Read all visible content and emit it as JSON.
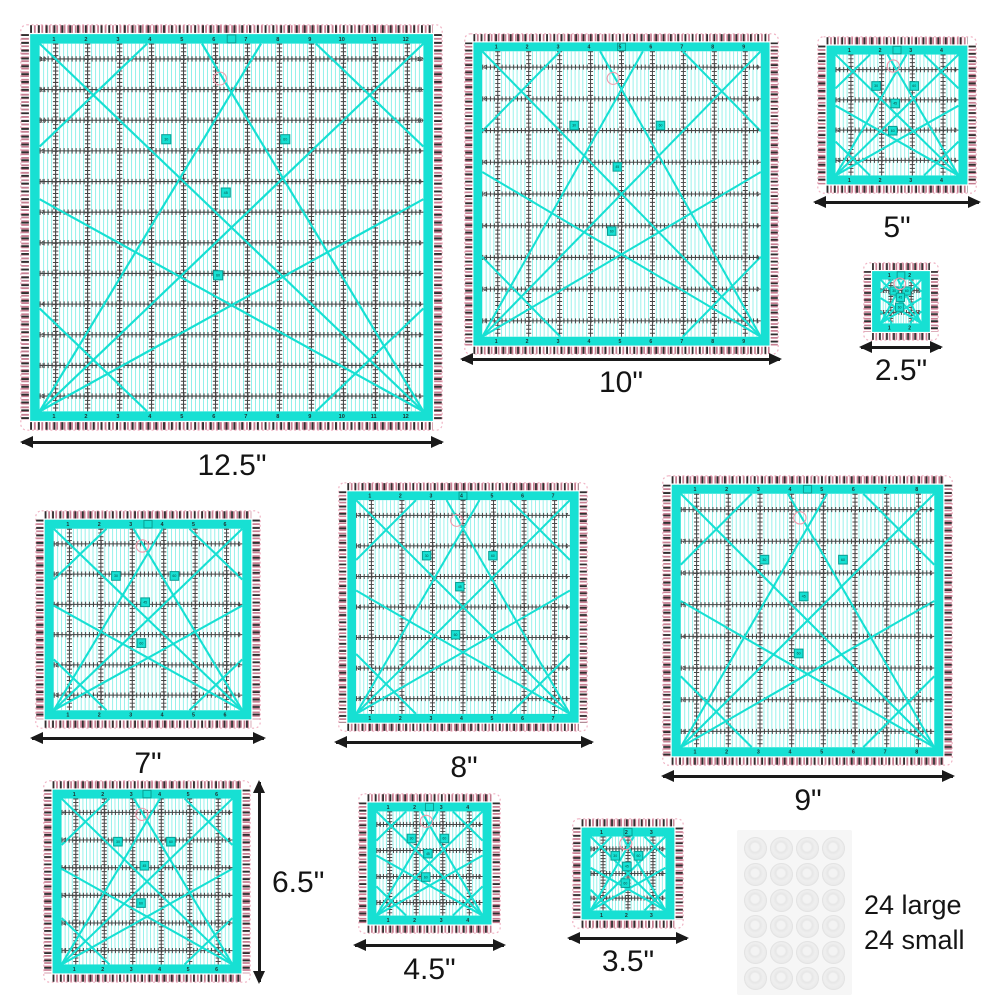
{
  "title": "Square quilting ruler set product image",
  "colors": {
    "teal": "#17e0d3",
    "teal_light": "#8df0e9",
    "teal_dark": "#0a9e93",
    "grid": "#454545",
    "num": "#1d2e2e",
    "tick_black": "#2f2f2f",
    "tick_pink": "#c77f92",
    "edge_dotted": "#f0b3c4",
    "pink_circle": "#ef9aac",
    "arrow": "#1a1a1a"
  },
  "angle_markers": [
    "30",
    "60",
    "45",
    "60"
  ],
  "rulers": [
    {
      "size_label": "12.5\"",
      "inches": 12.5,
      "grid_count": 12,
      "arrow": "bottom"
    },
    {
      "size_label": "10\"",
      "inches": 10,
      "grid_count": 9,
      "arrow": "bottom"
    },
    {
      "size_label": "5\"",
      "inches": 5,
      "grid_count": 4,
      "arrow": "bottom"
    },
    {
      "size_label": "2.5\"",
      "inches": 2.5,
      "grid_count": 2,
      "arrow": "bottom"
    },
    {
      "size_label": "7\"",
      "inches": 7,
      "grid_count": 6,
      "arrow": "bottom"
    },
    {
      "size_label": "8\"",
      "inches": 8,
      "grid_count": 7,
      "arrow": "bottom"
    },
    {
      "size_label": "9\"",
      "inches": 9,
      "grid_count": 8,
      "arrow": "bottom"
    },
    {
      "size_label": "6.5\"",
      "inches": 6.5,
      "grid_count": 6,
      "arrow": "right"
    },
    {
      "size_label": "4.5\"",
      "inches": 4.5,
      "grid_count": 4,
      "arrow": "bottom"
    },
    {
      "size_label": "3.5\"",
      "inches": 3.5,
      "grid_count": 3,
      "arrow": "bottom"
    }
  ],
  "dots_sheet": {
    "rows": 6,
    "cols": 4,
    "count_large": "24 large",
    "count_small": "24 small"
  }
}
